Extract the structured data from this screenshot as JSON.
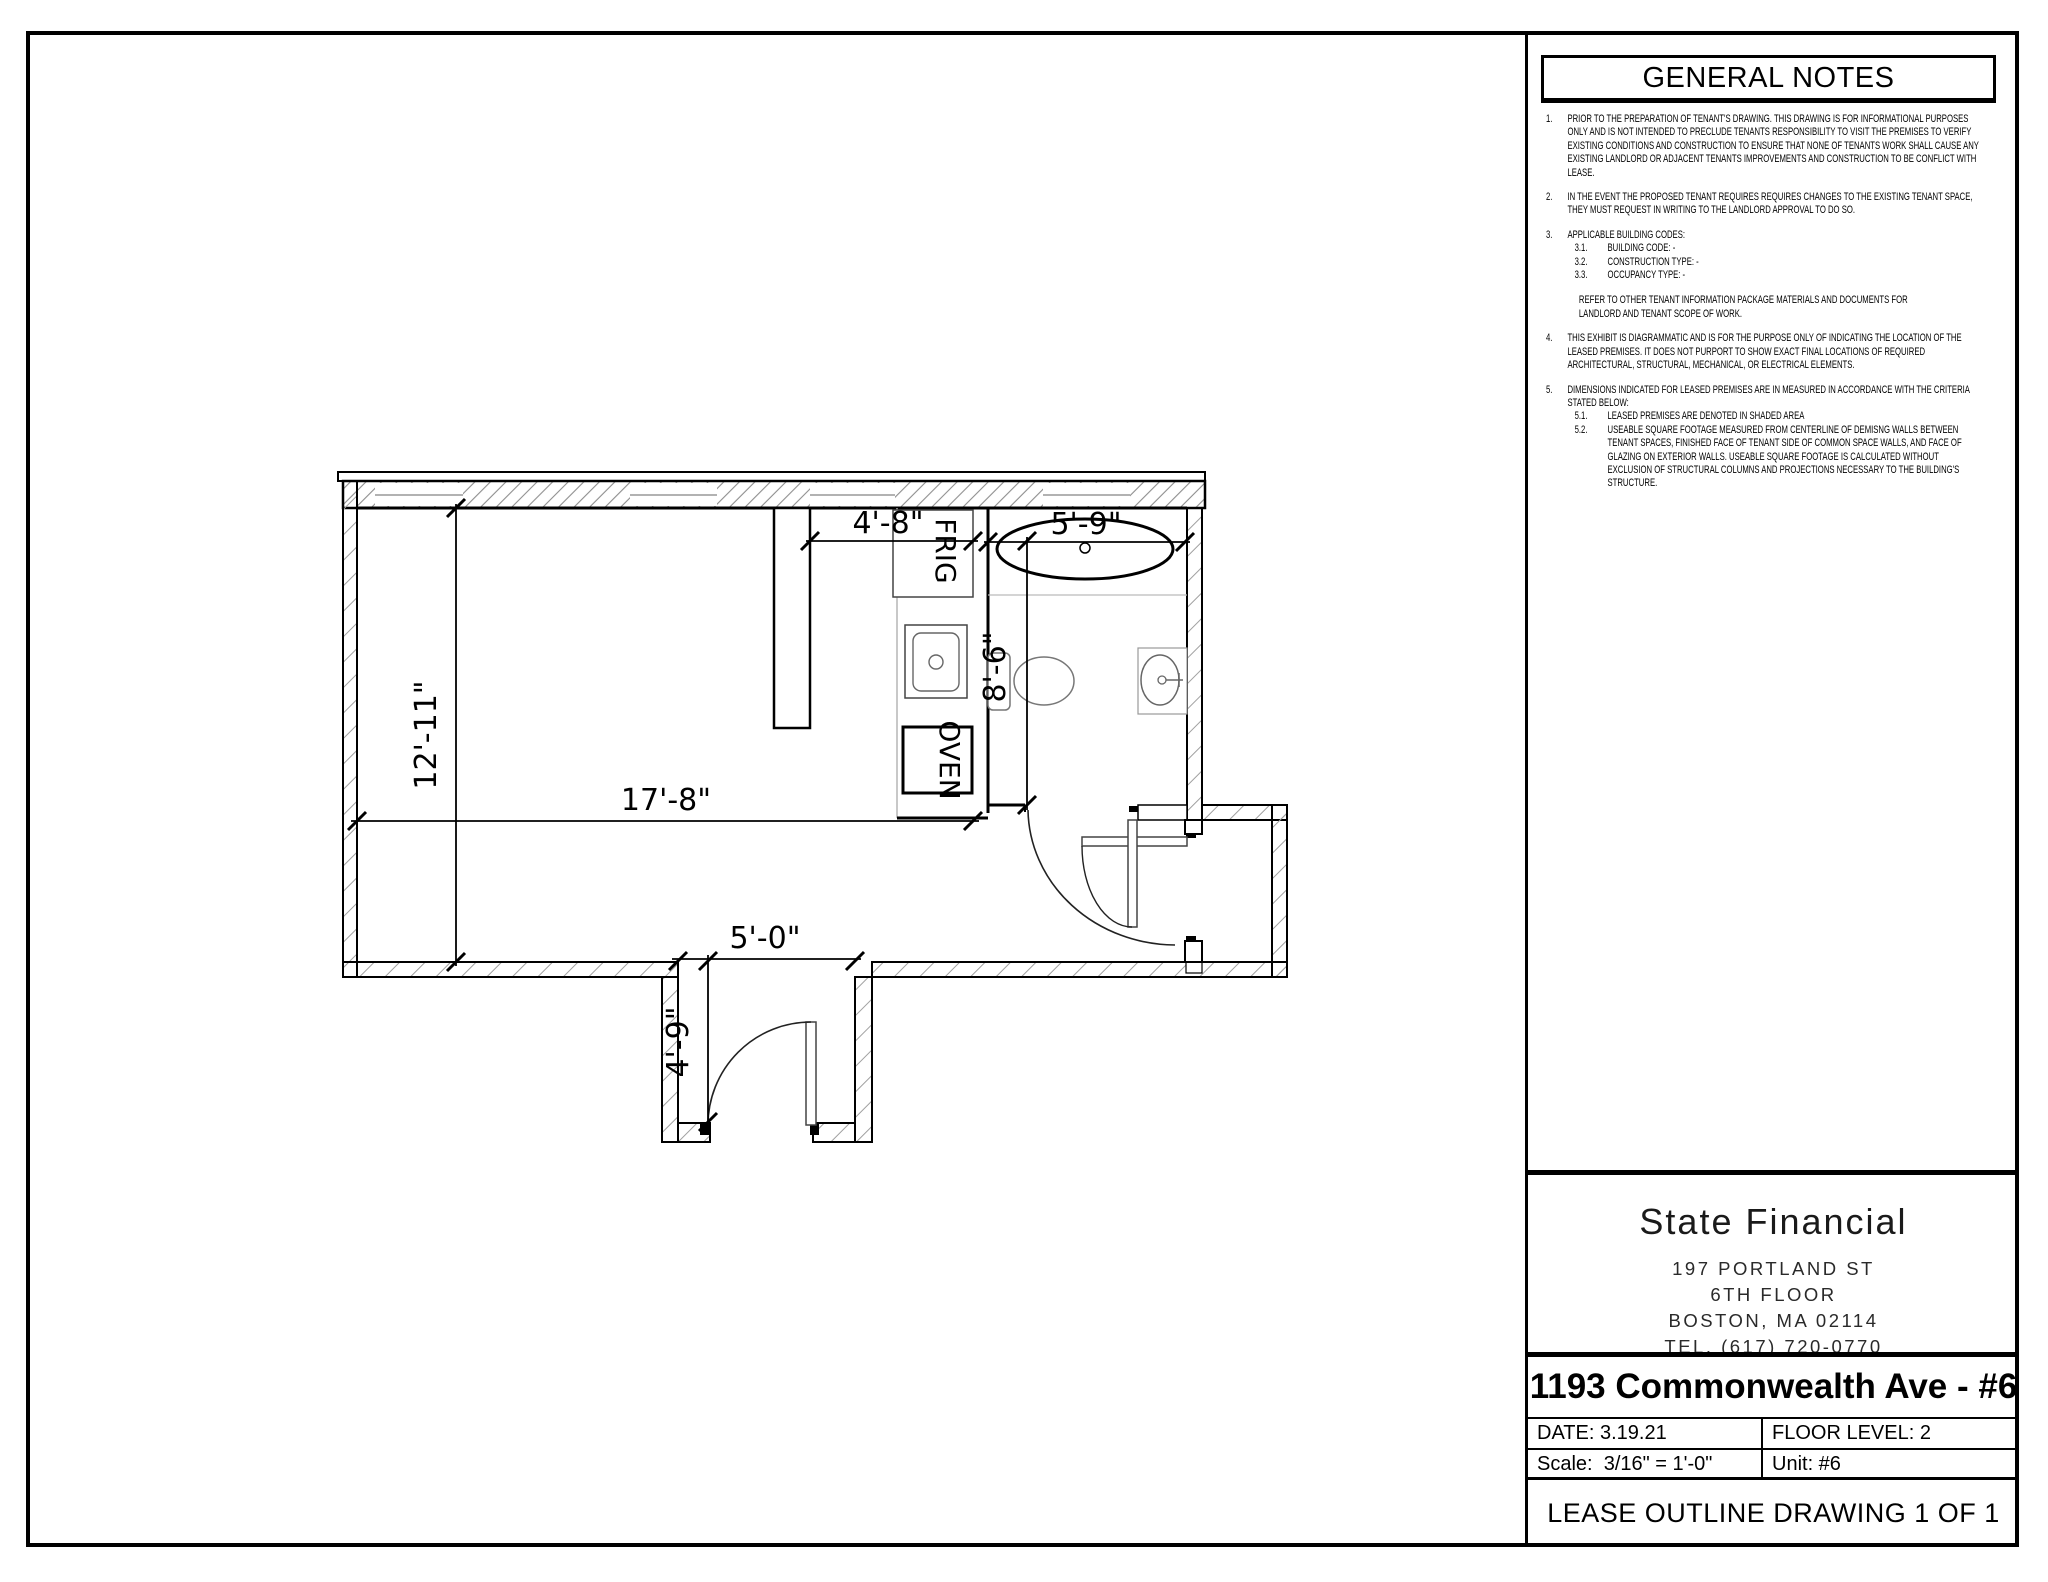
{
  "plan": {
    "dims": {
      "overall_width": "17'-8\"",
      "overall_depth": "12'-11\"",
      "kitchen_width": "4'-8\"",
      "bathroom_width": "5'-9\"",
      "bathroom_depth": "8'-6\"",
      "entry_width": "5'-0\"",
      "entry_depth": "4'-9\""
    },
    "labels": {
      "fridge": "FRIG",
      "oven": "OVEN"
    }
  },
  "notes": {
    "title": "GENERAL NOTES",
    "items": [
      {
        "num": "1.",
        "text": "PRIOR TO THE PREPARATION OF TENANT'S DRAWING.  THIS DRAWING IS FOR INFORMATIONAL PURPOSES ONLY AND IS NOT INTENDED TO PRECLUDE TENANTS RESPONSIBILITY TO VISIT THE PREMISES TO VERIFY EXISTING CONDITIONS AND CONSTRUCTION TO ENSURE THAT NONE OF TENANTS WORK SHALL CAUSE ANY EXISTING LANDLORD OR ADJACENT TENANTS IMPROVEMENTS AND CONSTRUCTION TO BE CONFLICT WITH LEASE."
      },
      {
        "num": "2.",
        "text": "IN THE EVENT THE PROPOSED TENANT REQUIRES REQUIRES CHANGES TO THE EXISTING TENANT SPACE, THEY MUST REQUEST  IN WRITING TO THE LANDLORD APPROVAL TO DO SO."
      },
      {
        "num": "3.",
        "text": "APPLICABLE BUILDING CODES:",
        "subs": [
          {
            "num": "3.1.",
            "text": "BUILDING CODE:    -"
          },
          {
            "num": "3.2.",
            "text": "CONSTRUCTION TYPE:      -"
          },
          {
            "num": "3.3.",
            "text": "OCCUPANCY TYPE: -"
          }
        ],
        "extra": "REFER TO OTHER TENANT INFORMATION PACKAGE MATERIALS AND DOCUMENTS FOR LANDLORD AND TENANT SCOPE OF WORK."
      },
      {
        "num": "4.",
        "text": "THIS EXHIBIT IS DIAGRAMMATIC AND IS FOR THE PURPOSE ONLY OF INDICATING THE LOCATION OF THE LEASED PREMISES.  IT DOES NOT PURPORT TO SHOW EXACT FINAL LOCATIONS OF REQUIRED ARCHITECTURAL, STRUCTURAL, MECHANICAL, OR ELECTRICAL ELEMENTS."
      },
      {
        "num": "5.",
        "text": "DIMENSIONS INDICATED FOR LEASED PREMISES ARE IN MEASURED IN ACCORDANCE WITH THE CRITERIA STATED BELOW:",
        "subs": [
          {
            "num": "5.1.",
            "text": "LEASED PREMISES ARE DENOTED IN SHADED AREA"
          },
          {
            "num": "5.2.",
            "text": "USEABLE SQUARE FOOTAGE MEASURED FROM CENTERLINE OF DEMISNG WALLS BETWEEN TENANT SPACES, FINISHED FACE OF TENANT SIDE OF COMMON SPACE WALLS, AND FACE OF GLAZING ON EXTERIOR WALLS.  USEABLE SQUARE FOOTAGE IS CALCULATED WITHOUT EXCLUSION OF STRUCTURAL COLUMNS AND PROJECTIONS NECESSARY TO THE BUILDING'S STRUCTURE."
          }
        ]
      }
    ]
  },
  "firm": {
    "name": "State Financial",
    "address_line1": "197 PORTLAND ST",
    "address_line2": "6TH FLOOR",
    "address_line3": "BOSTON, MA 02114",
    "phone": "TEL. (617) 720-0770"
  },
  "title_block": {
    "project_title": "1193 Commonwealth Ave - #6",
    "date": "DATE: 3.19.21",
    "floor_level": "FLOOR LEVEL: 2",
    "scale": "Scale:  3/16\" = 1'-0\"",
    "unit": "Unit: #6",
    "sheet_title": "LEASE OUTLINE DRAWING 1 OF 1"
  },
  "colors": {
    "ink": "#000000",
    "hatch": "#9a9a9a",
    "fixture": "#666666",
    "paper": "#ffffff"
  }
}
